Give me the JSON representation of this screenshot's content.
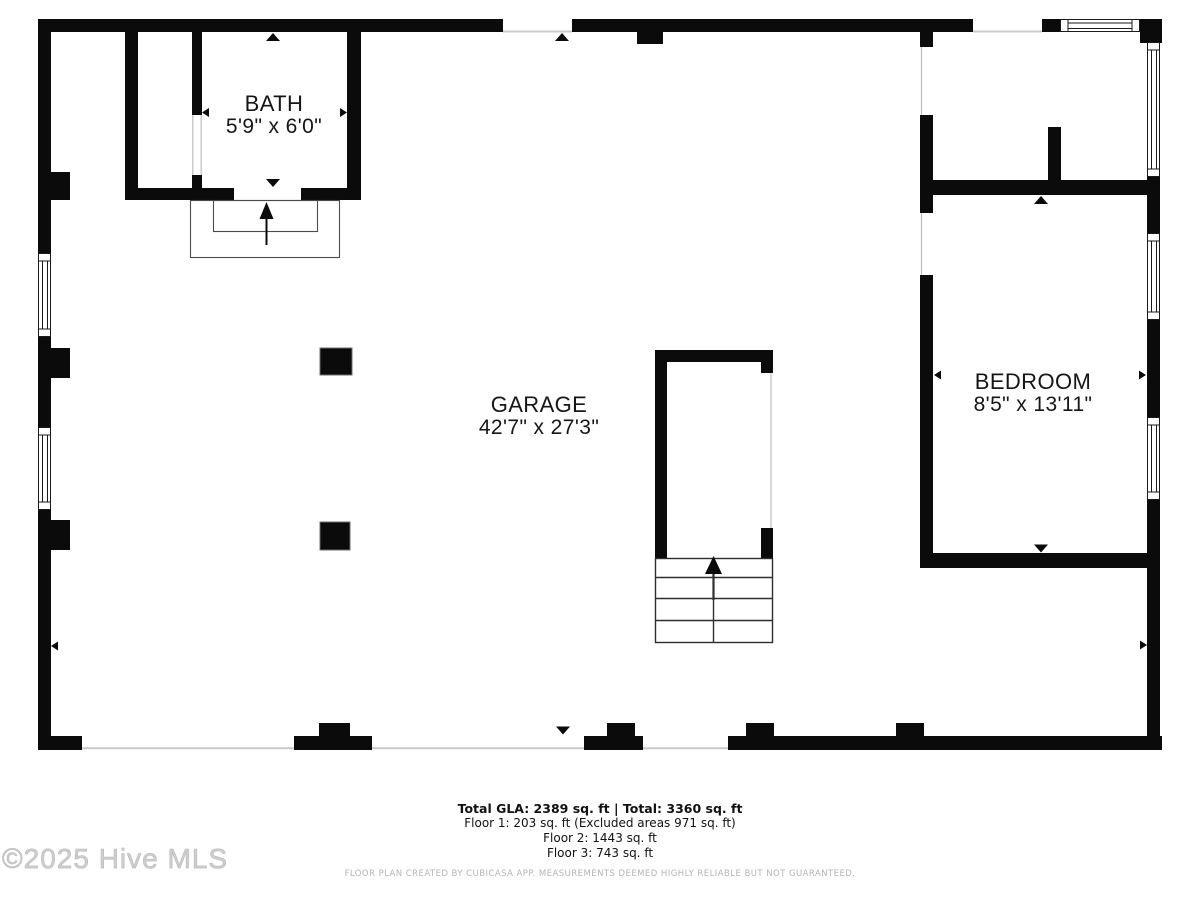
{
  "rooms": [
    {
      "id": "bath",
      "name": "BATH",
      "dims": "5'9\" x 6'0\""
    },
    {
      "id": "garage",
      "name": "GARAGE",
      "dims": "42'7\" x 27'3\""
    },
    {
      "id": "bedroom",
      "name": "BEDROOM",
      "dims": "8'5\" x 13'11\""
    }
  ],
  "summary": {
    "total_line": "Total GLA: 2389 sq. ft | Total: 3360 sq. ft",
    "floor1_line": "Floor 1: 203 sq. ft (Excluded areas 971 sq. ft)",
    "floor2_line": "Floor 2: 1443 sq. ft",
    "floor3_line": "Floor 3: 743 sq. ft"
  },
  "disclaimer": "FLOOR PLAN CREATED BY CUBICASA APP. MEASUREMENTS DEEMED HIGHLY RELIABLE BUT NOT GUARANTEED.",
  "watermark": "©2025 Hive MLS",
  "colors": {
    "wall": "#0b0b0b",
    "threshold_line": "#c9c9c9",
    "stair_line": "#2e2e2e",
    "watermark_gray": "#cfcfcf",
    "disclaimer_gray": "#b4b4b4"
  }
}
